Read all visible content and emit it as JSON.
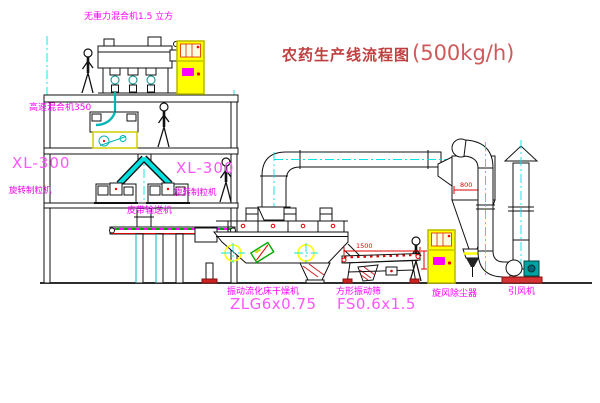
{
  "title": {
    "text": "农药生产线流程图",
    "capacity": "(500kg/h)"
  },
  "labels": {
    "mixer_top": "无重力混合机1.5 立方",
    "mixer_high_speed": "高速混合机350",
    "xl300_left": {
      "model": "XL-300",
      "name": "旋转制粒机"
    },
    "xl300_center": {
      "model": "XL-300",
      "name": "旋转制粒机"
    },
    "belt_conveyor": "皮带输送机",
    "dryer": {
      "name": "振动流化床干燥机",
      "model": "ZLG6x0.75"
    },
    "sieve": {
      "name": "方形振动筛",
      "model": "FS0.6x1.5"
    },
    "cyclone": "旋风除尘器",
    "fan": "引风机"
  },
  "dimensions": {
    "sieve_width": "1500",
    "cyclone_width": "800"
  },
  "colors": {
    "label_magenta": "#ff00ff",
    "centerline_cyan": "#00e5e5",
    "dimension_red": "#e00000",
    "cabinet_yellow": "#ffff00",
    "title_red": "#c04040",
    "equipment_teal": "#00b7b7"
  }
}
